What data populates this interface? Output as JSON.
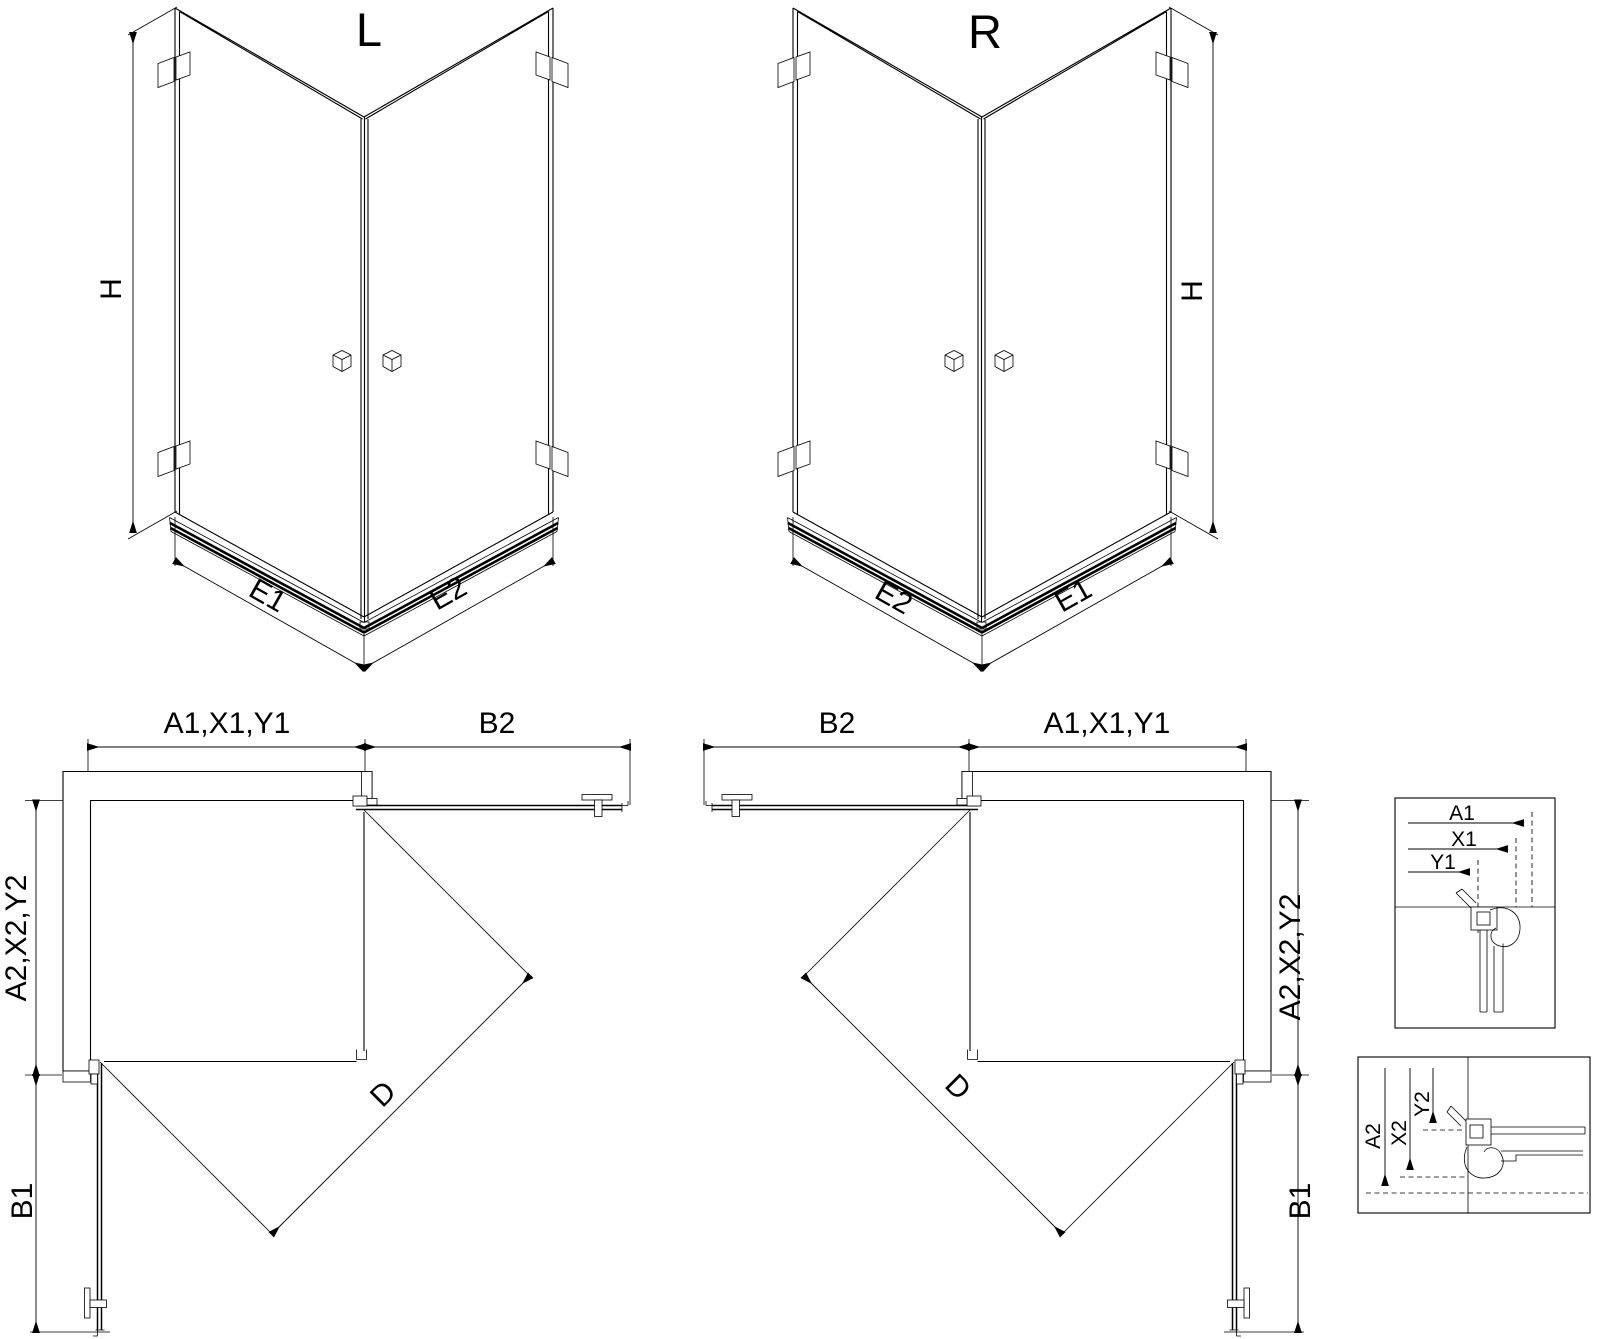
{
  "page": {
    "background": "#ffffff",
    "ink": "#000000"
  },
  "views": {
    "iso_left": {
      "title": "L",
      "dim_height": "H",
      "dim_bottom_left": "E1",
      "dim_bottom_right": "E2"
    },
    "iso_right": {
      "title": "R",
      "dim_height": "H",
      "dim_bottom_left": "E2",
      "dim_bottom_right": "E1"
    },
    "plan_left": {
      "dim_top_left": "A1,X1,Y1",
      "dim_top_right": "B2",
      "dim_side_upper": "A2,X2,Y2",
      "dim_side_lower": "B1",
      "dim_diagonal": "D"
    },
    "plan_right": {
      "dim_top_left": "B2",
      "dim_top_right": "A1,X1,Y1",
      "dim_side_upper": "A2,X2,Y2",
      "dim_side_lower": "B1",
      "dim_diagonal": "D"
    },
    "detail_horizontal": {
      "dims": [
        "A1",
        "X1",
        "Y1"
      ]
    },
    "detail_vertical": {
      "dims": [
        "A2",
        "X2",
        "Y2"
      ]
    }
  }
}
